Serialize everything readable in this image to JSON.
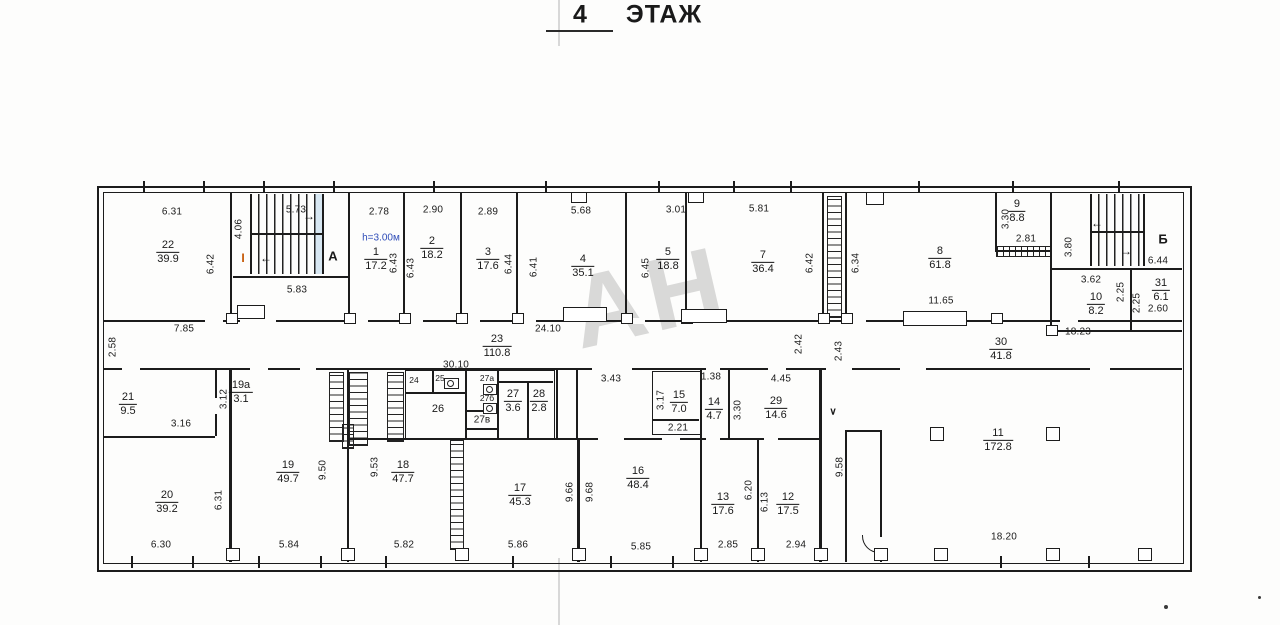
{
  "title": {
    "number": "4",
    "word": "ЭТАЖ"
  },
  "watermark": "АН",
  "annotations": {
    "height_note": "h=3.00м",
    "section_mark": "I",
    "stair_a": "А",
    "stair_b": "Б"
  },
  "icons": {
    "arrow_right": "→",
    "arrow_left": "←",
    "arrow_down": "∨"
  },
  "colors": {
    "ink": "#1c1c1c",
    "height_note_blue": "#2f4db8",
    "section_mark_orange": "#c45500",
    "watermark_gray": "#a9a9a9"
  },
  "rooms": [
    {
      "num": "22",
      "area": "39.9"
    },
    {
      "num": "1",
      "area": "17.2"
    },
    {
      "num": "2",
      "area": "18.2"
    },
    {
      "num": "3",
      "area": "17.6"
    },
    {
      "num": "4",
      "area": "35.1"
    },
    {
      "num": "5",
      "area": "18.8"
    },
    {
      "num": "7",
      "area": "36.4"
    },
    {
      "num": "8",
      "area": "61.8"
    },
    {
      "num": "9",
      "area": "8.8"
    },
    {
      "num": "10",
      "area": "8.2"
    },
    {
      "num": "31",
      "area": "6.1"
    },
    {
      "num": "23",
      "area": "110.8"
    },
    {
      "num": "30",
      "area": "41.8"
    },
    {
      "num": "21",
      "area": "9.5"
    },
    {
      "num": "19а",
      "area": "3.1"
    },
    {
      "num": "27",
      "area": "3.6"
    },
    {
      "num": "28",
      "area": "2.8"
    },
    {
      "num": "15",
      "area": "7.0"
    },
    {
      "num": "14",
      "area": "4.7"
    },
    {
      "num": "29",
      "area": "14.6"
    },
    {
      "num": "20",
      "area": "39.2"
    },
    {
      "num": "19",
      "area": "49.7"
    },
    {
      "num": "18",
      "area": "47.7"
    },
    {
      "num": "17",
      "area": "45.3"
    },
    {
      "num": "16",
      "area": "48.4"
    },
    {
      "num": "13",
      "area": "17.6"
    },
    {
      "num": "12",
      "area": "17.5"
    },
    {
      "num": "11",
      "area": "172.8"
    }
  ],
  "tags": [
    "24",
    "25",
    "27а",
    "27б",
    "26",
    "27в"
  ],
  "dims_h": [
    "6.31",
    "5.73",
    "2.78",
    "2.90",
    "2.89",
    "5.68",
    "3.01",
    "5.81",
    "2.81",
    "3.62",
    "6.44",
    "2.60",
    "5.83",
    "7.85",
    "24.10",
    "30.10",
    "11.65",
    "18.23",
    "3.16",
    "3.43",
    "1.38",
    "4.45",
    "2.21",
    "6.30",
    "5.84",
    "5.82",
    "5.86",
    "5.85",
    "2.85",
    "2.94",
    "18.20"
  ],
  "dims_v": [
    "4.06",
    "6.42",
    "6.43",
    "6.43",
    "6.44",
    "6.41",
    "6.45",
    "6.42",
    "6.34",
    "3.30",
    "3.80",
    "2.25",
    "2.25",
    "2.58",
    "3.12",
    "3.17",
    "3.30",
    "2.42",
    "2.43",
    "9.58",
    "6.31",
    "9.50",
    "9.53",
    "9.66",
    "9.68",
    "6.20",
    "6.13"
  ]
}
